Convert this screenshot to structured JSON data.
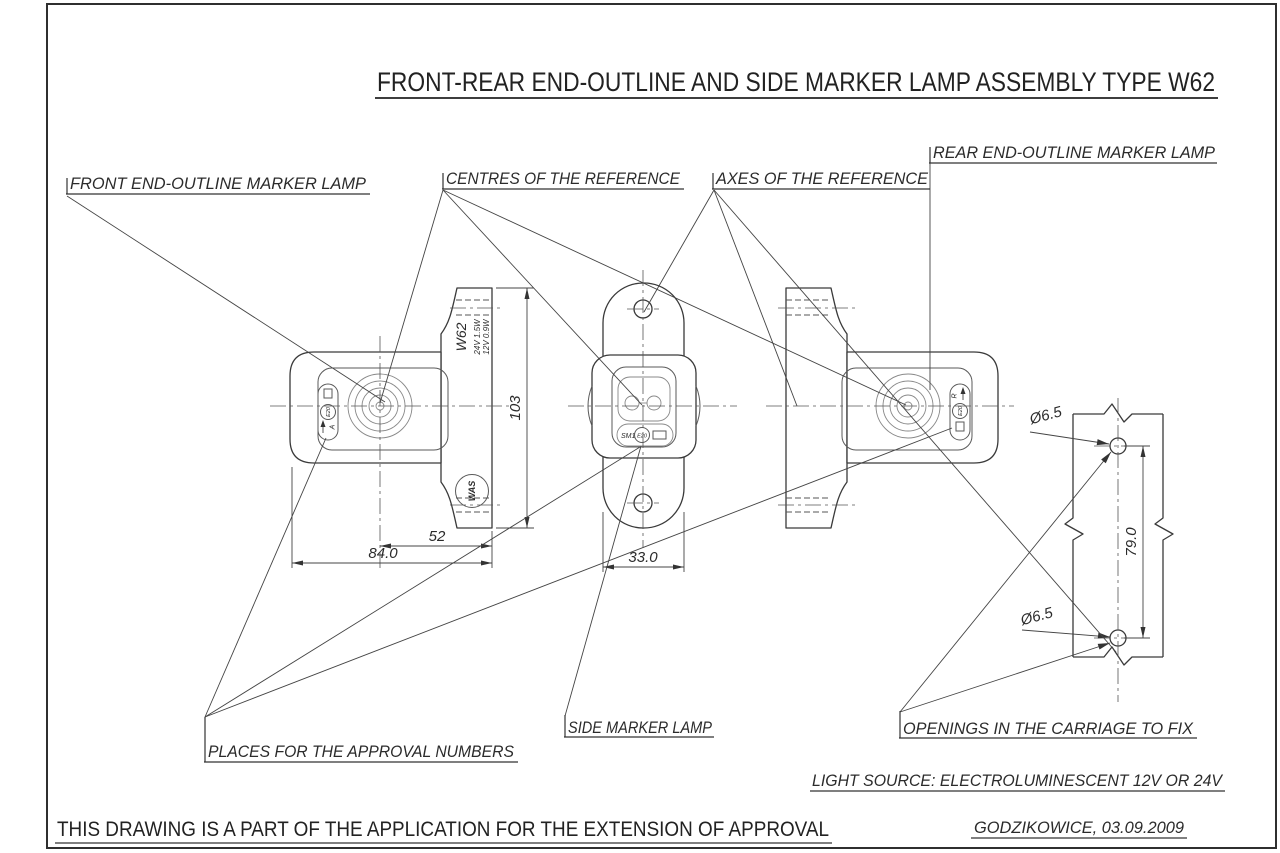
{
  "title": "FRONT-REAR END-OUTLINE AND SIDE MARKER LAMP ASSEMBLY TYPE W62",
  "callouts": {
    "front_lamp": "FRONT END-OUTLINE MARKER LAMP",
    "centres": "CENTRES OF THE REFERENCE",
    "axes": "AXES OF THE REFERENCE",
    "rear_lamp": "REAR END-OUTLINE MARKER LAMP",
    "approval_places": "PLACES FOR THE APPROVAL NUMBERS",
    "side_lamp": "SIDE MARKER LAMP",
    "openings": "OPENINGS IN THE CARRIAGE TO FIX"
  },
  "dimensions": {
    "front_height": "103",
    "front_offset": "52",
    "front_width": "84.0",
    "side_width": "33.0",
    "hole_spacing": "79.0",
    "hole_dia_top": "Ø6.5",
    "hole_dia_bottom": "Ø6.5"
  },
  "markings": {
    "model": "W62",
    "power_24v": "24V 1.5W",
    "power_12v": "12V 0.9W",
    "front_letter": "A",
    "rear_letter": "R",
    "e_mark_front": "E20",
    "e_mark_side": "E20",
    "e_mark_rear": "E20",
    "side_code": "SM1",
    "logo": "WAS"
  },
  "notes": {
    "light_source": "LIGHT SOURCE: ELECTROLUMINESCENT 12V OR 24V",
    "statement": "THIS DRAWING IS A PART OF THE APPLICATION FOR THE EXTENSION OF APPROVAL",
    "place_date": "GODZIKOWICE, 03.09.2009"
  }
}
